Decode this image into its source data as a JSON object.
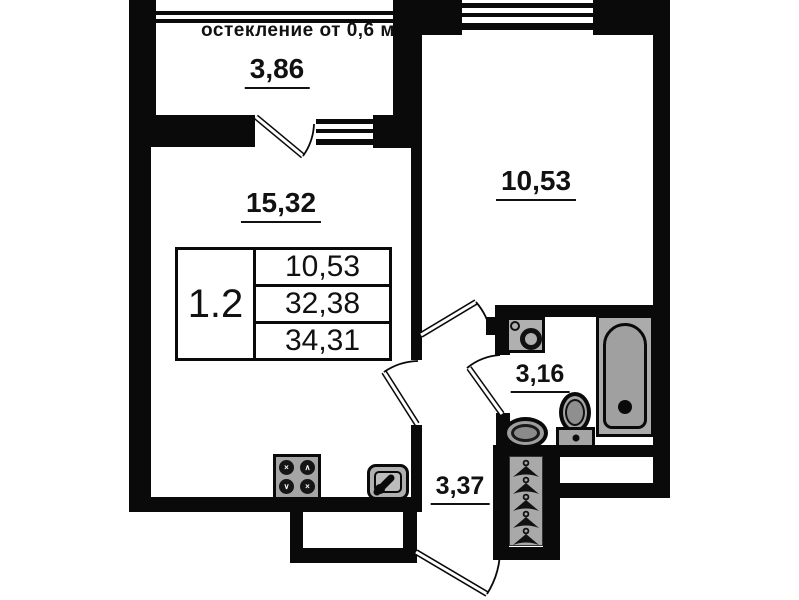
{
  "floor_plan": {
    "balcony": {
      "glazing_note": "остекление от 0,6 м",
      "area": "3,86"
    },
    "living_room": {
      "area": "15,32"
    },
    "room": {
      "area": "10,53"
    },
    "bathroom": {
      "area": "3,16"
    },
    "hallway": {
      "area": "3,37"
    },
    "legend_table": {
      "unit_label": "1.2",
      "rows": [
        "10,53",
        "32,38",
        "34,31"
      ]
    },
    "stove_burner_marks": [
      "×",
      "∧",
      "∨",
      "×"
    ],
    "colors": {
      "wall": "#0a0a0a",
      "fixture_fill": "#ababab",
      "background": "#ffffff",
      "text": "#111111"
    }
  }
}
